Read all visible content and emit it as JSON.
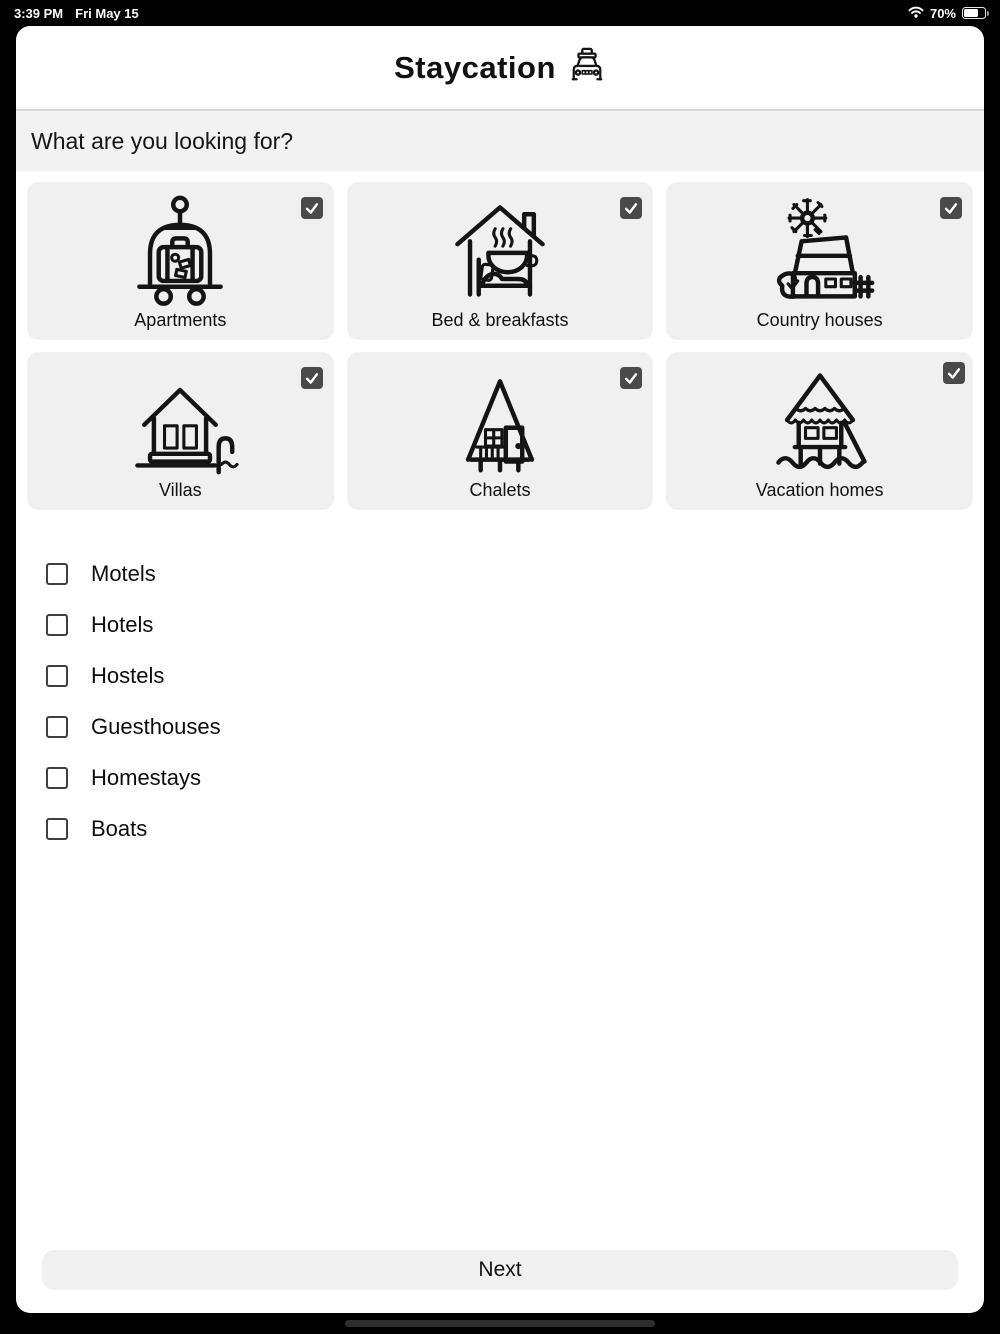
{
  "status_bar": {
    "time": "3:39 PM",
    "date": "Fri May 15",
    "battery_percent": "70%"
  },
  "header": {
    "title": "Staycation",
    "icon": "taxi-icon"
  },
  "question": "What are you looking for?",
  "cards": [
    {
      "label": "Apartments",
      "icon": "luggage-cart-icon",
      "checked": true
    },
    {
      "label": "Bed & breakfasts",
      "icon": "bed-breakfast-icon",
      "checked": true
    },
    {
      "label": "Country houses",
      "icon": "country-house-icon",
      "checked": true
    },
    {
      "label": "Villas",
      "icon": "villa-icon",
      "checked": true
    },
    {
      "label": "Chalets",
      "icon": "chalet-icon",
      "checked": true
    },
    {
      "label": "Vacation homes",
      "icon": "stilt-house-icon",
      "checked": true
    }
  ],
  "list_options": [
    {
      "label": "Motels",
      "checked": false
    },
    {
      "label": "Hotels",
      "checked": false
    },
    {
      "label": "Hostels",
      "checked": false
    },
    {
      "label": "Guesthouses",
      "checked": false
    },
    {
      "label": "Homestays",
      "checked": false
    },
    {
      "label": "Boats",
      "checked": false
    }
  ],
  "footer": {
    "next_label": "Next"
  },
  "colors": {
    "status_bar_bg": "#000000",
    "surface": "#ffffff",
    "question_bg": "#f2f2f2",
    "card_bg": "#f0f0f0",
    "checkbox_checked": "#4a4a4a",
    "icon_stroke": "#141414"
  }
}
